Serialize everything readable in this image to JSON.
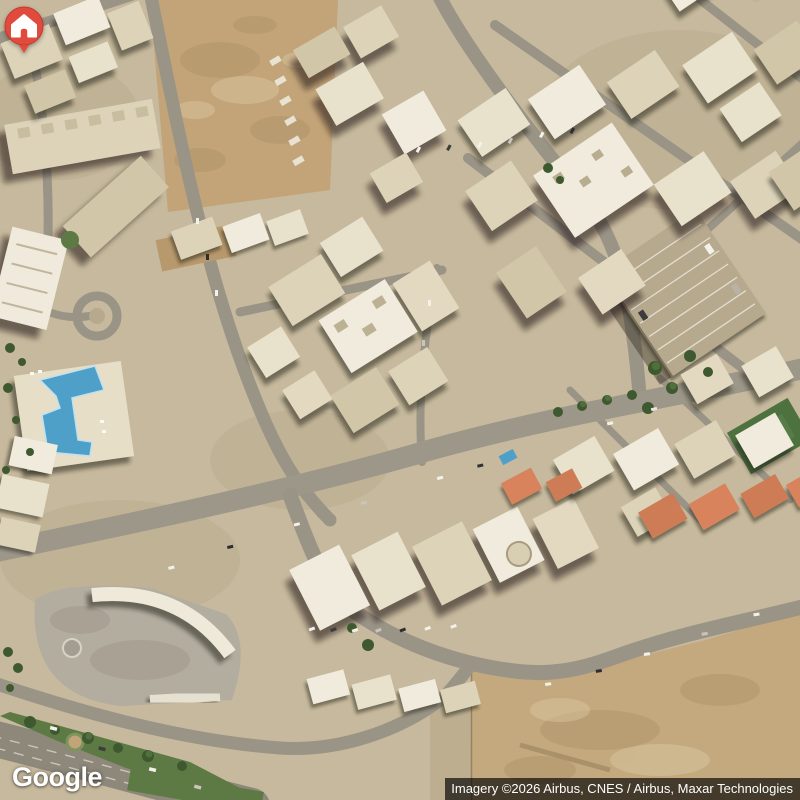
{
  "view": {
    "type": "satellite"
  },
  "branding": {
    "logo": "Google"
  },
  "attribution": {
    "text": "Imagery ©2026 Airbus, CNES / Airbus, Maxar Technologies"
  },
  "marker": {
    "kind": "home",
    "color": "#E04B3E"
  },
  "colors": {
    "terrain_base": "#C6B99D",
    "road": "#9A9486",
    "dirt": "#C2A478",
    "pool_water": "#4FA0C8",
    "vegetation": "#3E5930",
    "building_light": "#EFEADB",
    "attribution_bg": "rgba(0,0,0,0.66)"
  }
}
